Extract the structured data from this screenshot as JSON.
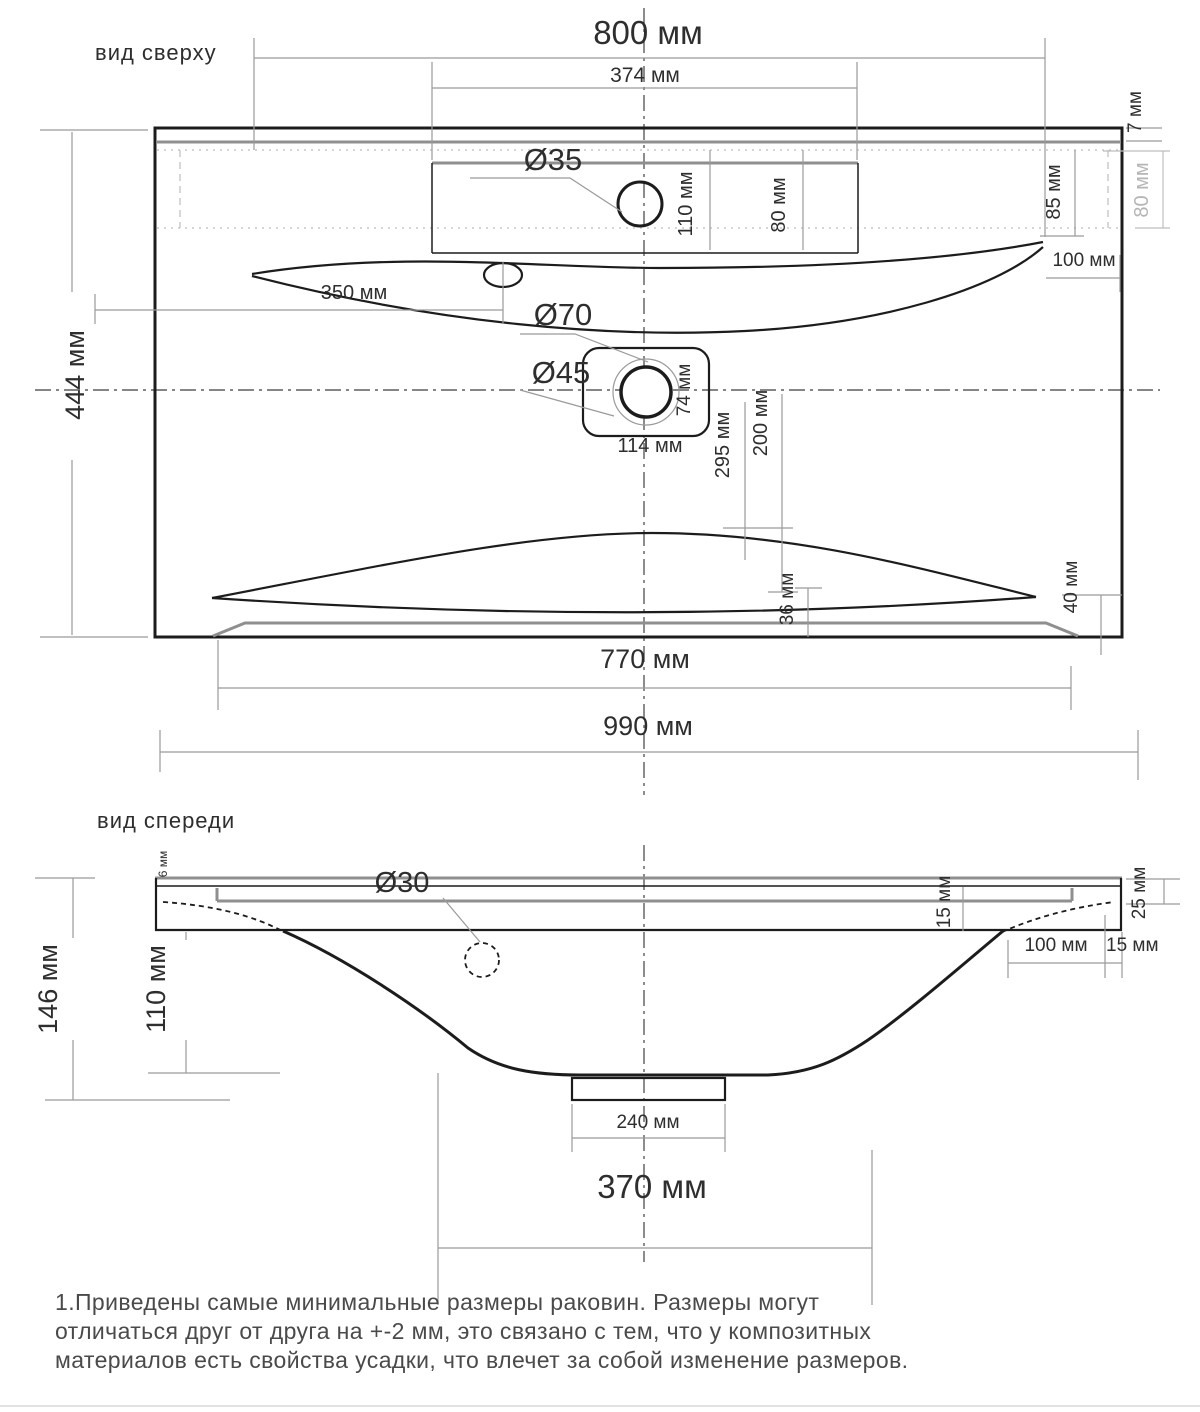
{
  "top_view": {
    "label": "вид сверху",
    "dims": {
      "width_top": "800 мм",
      "faucet_zone_width": "374 мм",
      "depth": "444 мм",
      "faucet_hole_dia": "Ø35",
      "overflow_dia": "Ø70",
      "drain_dia": "Ø45",
      "faucet_offset_110": "110 мм",
      "faucet_offset_80": "80 мм",
      "rim_7": "7 мм",
      "edge_85": "85 мм",
      "edge_80_grey": "80 мм",
      "corner_100": "100 мм",
      "overflow_offset_350": "350 мм",
      "drain_box_width": "114 мм",
      "drain_box_height": "74 мм",
      "basin_295": "295 мм",
      "basin_200": "200 мм",
      "ledge_36": "36 мм",
      "ledge_40": "40 мм",
      "bottom_width": "770 мм",
      "total_width": "990 мм"
    }
  },
  "front_view": {
    "label": "вид спереди",
    "dims": {
      "drain_dia": "Ø30",
      "lip_6": "6 мм",
      "height_total": "146 мм",
      "bowl_depth": "110 мм",
      "recess_15": "15 мм",
      "edge_25": "25 мм",
      "corner_100": "100 мм",
      "corner_15": "15 мм",
      "trap_width": "240 мм",
      "bowl_width": "370 мм"
    }
  },
  "note": {
    "line1": "1.Приведены самые минимальные размеры раковин. Размеры могут",
    "line2": "отличаться друг от друга на +-2 мм, это связано с тем, что у композитных",
    "line3": "материалов есть свойства усадки, что влечет за собой изменение размеров."
  }
}
